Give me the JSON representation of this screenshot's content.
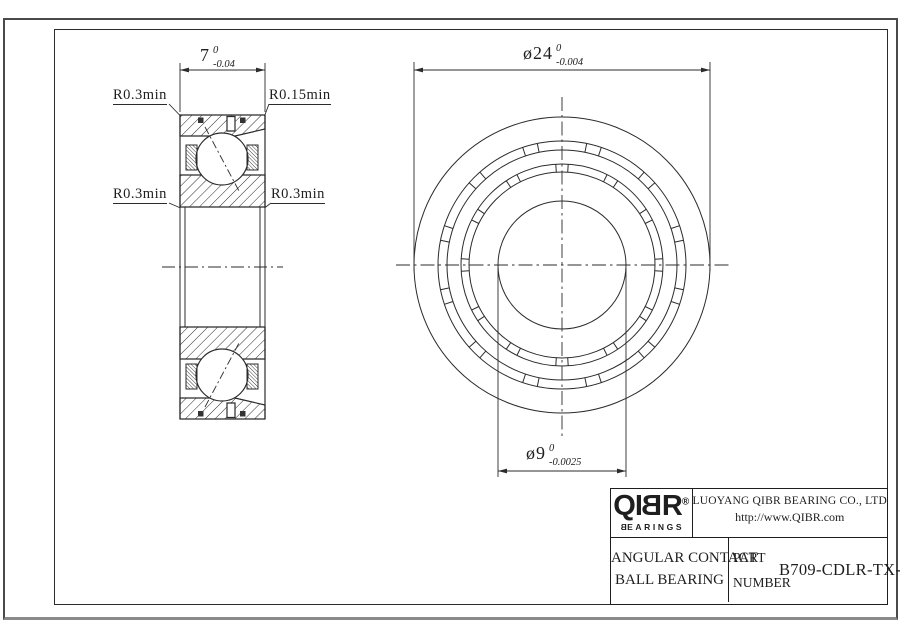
{
  "left_view": {
    "labels": {
      "top_left": "R0.3min",
      "top_right": "R0.15min",
      "mid_left": "R0.3min",
      "mid_right": "R0.3min"
    },
    "width_dim": {
      "value": "7",
      "upper_tol": "0",
      "lower_tol": "-0.04"
    }
  },
  "front_view": {
    "od_dim": {
      "value": "ø24",
      "upper_tol": "0",
      "lower_tol": "-0.004"
    },
    "bore_dim": {
      "value": "ø9",
      "upper_tol": "0",
      "lower_tol": "-0.0025"
    }
  },
  "title_block": {
    "logo": {
      "part1": "QI",
      "part2": "B",
      "part3": "R",
      "registered": "®",
      "sub_part1": "B",
      "sub_part2": "EARINGS"
    },
    "company": "LUOYANG QIBR BEARING CO., LTD",
    "website": "http://www.QIBR.com",
    "product_line1": "ANGULAR CONTACT",
    "product_line2": "BALL BEARING",
    "part_label_line1": "PART",
    "part_label_line2": "NUMBER",
    "part_number": "B709-CDLR-TX-P2"
  },
  "colors": {
    "line": "#2b2b2b",
    "background": "#ffffff"
  }
}
